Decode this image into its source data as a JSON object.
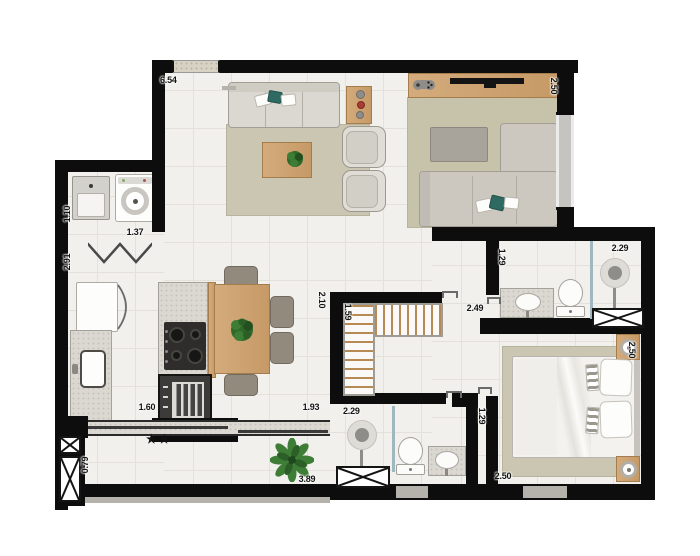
{
  "plan": {
    "balcony_note": "★★"
  },
  "dims": {
    "living_top_width": "6.54",
    "den_width": "2.50",
    "laundry_width": "1.10",
    "laundry_depth": "2.91",
    "laundry_opening": "1.37",
    "living_hall": "2.10",
    "closet_depth": "1.59",
    "hall_length": "2.49",
    "bath1_depth": "1.29",
    "bath1_width": "2.29",
    "bedroom_width": "2.50",
    "kitchen_opening": "1.60",
    "dining_opening": "1.93",
    "bath2_width": "2.29",
    "bath2_depth": "1.29",
    "balcony_depth": "0.79",
    "balcony_width": "3.89",
    "bedroom_length": "2.50"
  },
  "colors": {
    "wall": "#0d0d0d",
    "floor": "#f1f0ec",
    "grid": "#e3e1d9",
    "rug": "#cac6b1",
    "wood": "#cb9e6c",
    "teal": "#2e6a62",
    "granite": "#dbd8d2",
    "fabric": "#d6d3cb",
    "plant": "#3c7c34",
    "glass": "#9fb8c0",
    "gray_sill": "#b5b2ac",
    "text": "#141414"
  }
}
